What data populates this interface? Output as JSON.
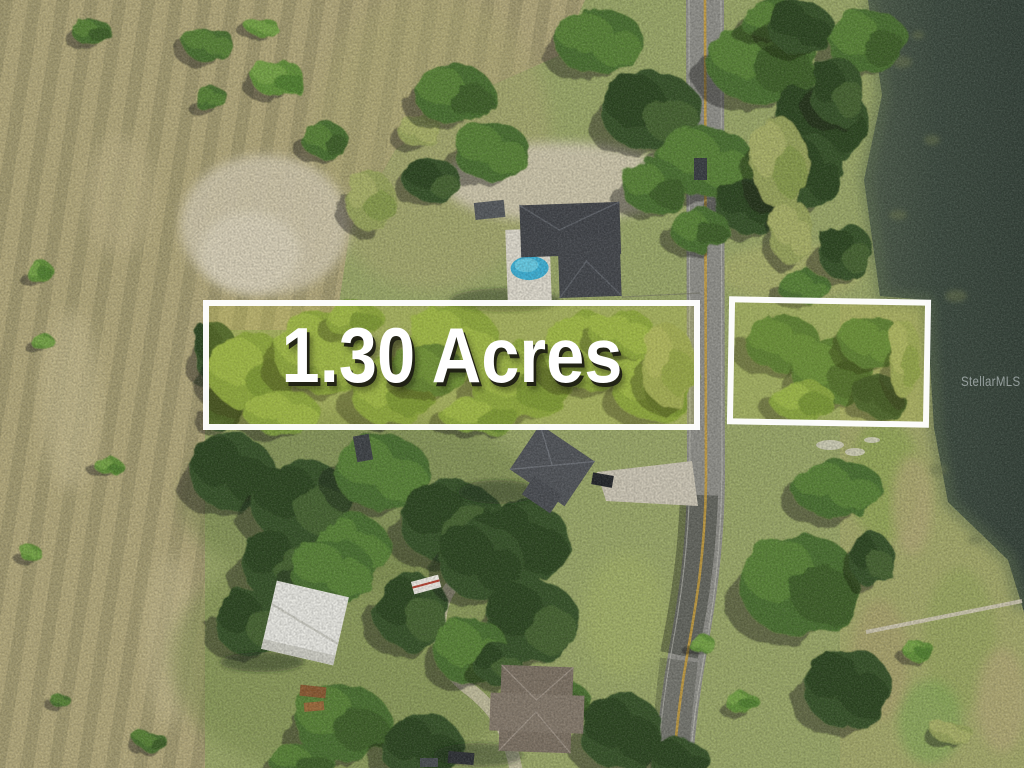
{
  "photo": {
    "kind": "aerial-drone-real-estate-photo",
    "features": [
      "scrub-field-rows",
      "tree-canopy",
      "rural-road",
      "lake-water",
      "marsh-reeds",
      "house-roofs",
      "swimming-pool",
      "white-shed",
      "boat-dock",
      "driveways",
      "vehicles"
    ]
  },
  "annotations": {
    "acreage_label": "1.30 Acres",
    "watermark": "StellarMLS"
  },
  "parcels": [
    {
      "name": "main-parcel",
      "label": "1.30 Acres"
    },
    {
      "name": "secondary-parcel",
      "label": ""
    }
  ],
  "colors": {
    "parcel_border": "#ffffff",
    "parcel_tint": "rgba(205,210,60,0.20)",
    "acreage_text": "#ffffff",
    "acreage_shadow": "rgba(28,28,20,0.92)",
    "watermark_text": "rgba(223,230,234,0.55)",
    "water_deep": "#37443a",
    "water_shore": "#5e6f50",
    "scrub_field": "#b3a87c",
    "grass": "#9aa768",
    "road": "#90908a",
    "road_centerline": "#c79f3e"
  }
}
